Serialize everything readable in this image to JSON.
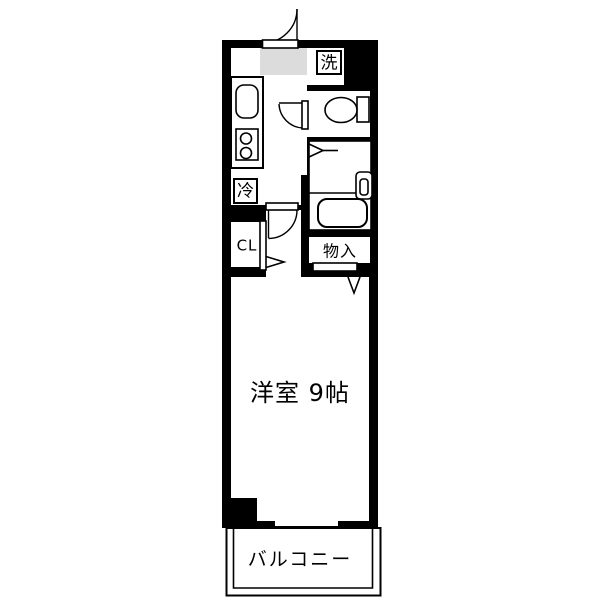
{
  "colors": {
    "wall": "#000000",
    "floor": "#ffffff",
    "mat": "#dcdcdc",
    "text": "#000000",
    "page": "#ffffff"
  },
  "labels": {
    "laundry": "洗",
    "refrigerator": "冷",
    "closet": "CL",
    "storage": "物入",
    "main_room": "洋室 9帖",
    "balcony": "バルコニー"
  }
}
